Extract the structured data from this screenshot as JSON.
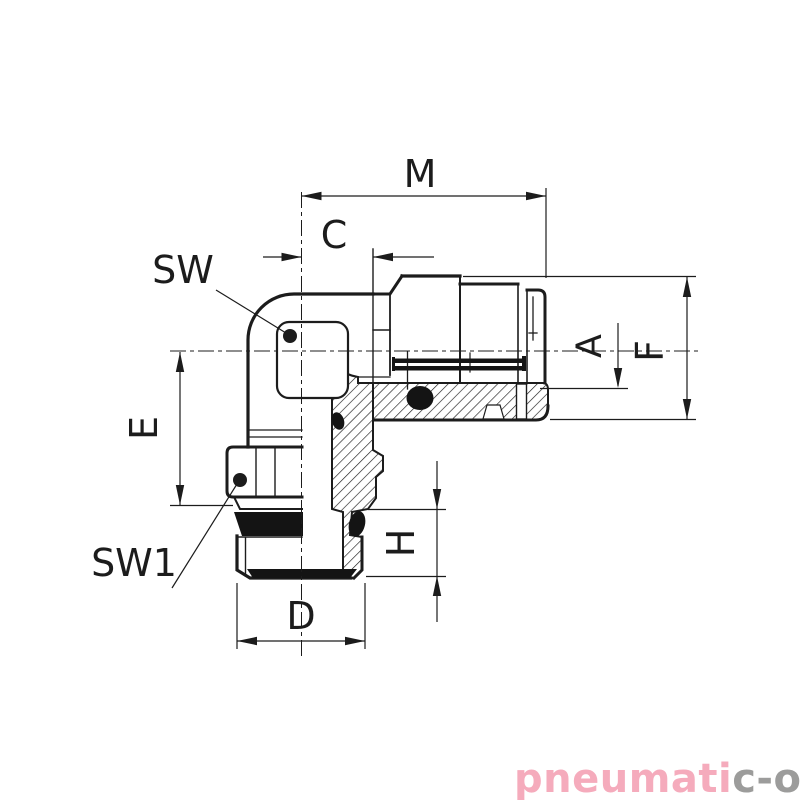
{
  "drawing": {
    "type": "technical-drawing",
    "subject": "elbow push-in fitting with male thread, half-section view",
    "dimension_labels": {
      "m": "M",
      "c": "C",
      "sw": "SW",
      "a": "A",
      "f": "F",
      "e": "E",
      "sw1": "SW1",
      "h": "H",
      "d": "D"
    }
  },
  "logo": {
    "text_primary": "pneumati",
    "text_secondary": "c-o",
    "registered": "®",
    "color_primary": "#f5abbc",
    "color_secondary": "#9c9c9b"
  },
  "colors": {
    "ink": "#1c1c1c",
    "background": "#ffffff"
  }
}
